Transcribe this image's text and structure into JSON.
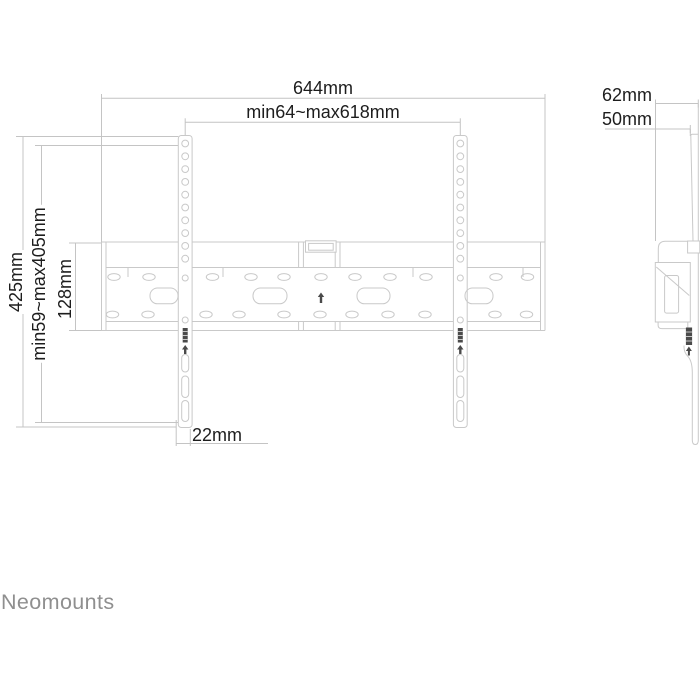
{
  "colors": {
    "drawing_line": "#c9c9c9",
    "dimension_line": "#c4c4c4",
    "label_text": "#1d1d1d",
    "dark_detail": "#4a4a4a",
    "brand_text": "#8f8f8f"
  },
  "front_view": {
    "total_width": "644mm",
    "adjustable_width": "min64~max618mm",
    "total_height": "425mm",
    "adjustable_height": "min59~max405mm",
    "plate_height": "128mm",
    "rail_offset": "22mm"
  },
  "side_view": {
    "total_depth": "62mm",
    "profile_depth": "50mm"
  },
  "brand": "Neomounts"
}
